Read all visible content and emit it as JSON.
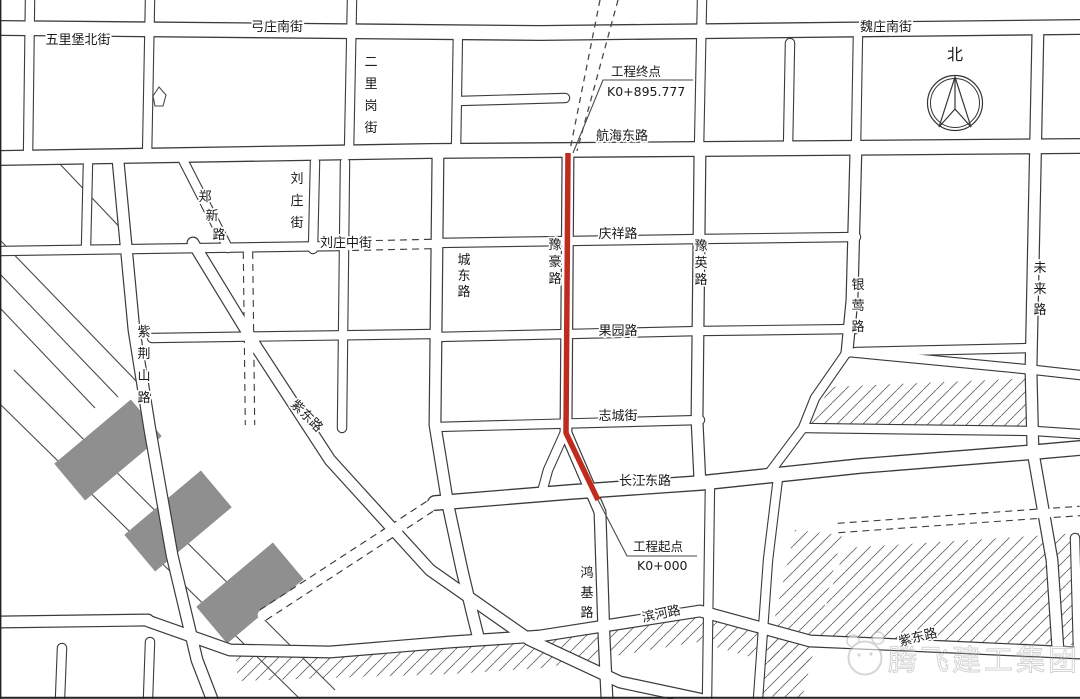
{
  "map": {
    "north_label": "北",
    "route_color": "#bf2b1e",
    "gray_block_color": "#8f8f8f",
    "project": {
      "end": {
        "title": "工程终点",
        "chainage": "K0+895.777"
      },
      "start": {
        "title": "工程起点",
        "chainage": "K0+000"
      }
    },
    "roads": {
      "wulibao_north": "五里堡北街",
      "gongzhuang_south": "弓庄南街",
      "weizhuang_south": "魏庄南街",
      "erligang": "二里岗街",
      "hanghai_east": "航海东路",
      "zhengxin": "郑新路",
      "liuzhuang": "刘庄街",
      "liuzhuang_middle": "刘庄中街",
      "chengdong": "城东路",
      "yuhao": "豫豪路",
      "qingxiang": "庆祥路",
      "yuying": "豫英路",
      "yinying": "银莺路",
      "weilai": "未来路",
      "guoyuan": "果园路",
      "zhicheng": "志城街",
      "changjiang_east": "长江东路",
      "zijinshan": "紫荆山路",
      "zidong_nw": "紫东路",
      "zidong_se": "紫东路",
      "hongji": "鸿基路",
      "binhe": "滨河路"
    },
    "watermark": {
      "text": "腾飞建工集团"
    }
  }
}
